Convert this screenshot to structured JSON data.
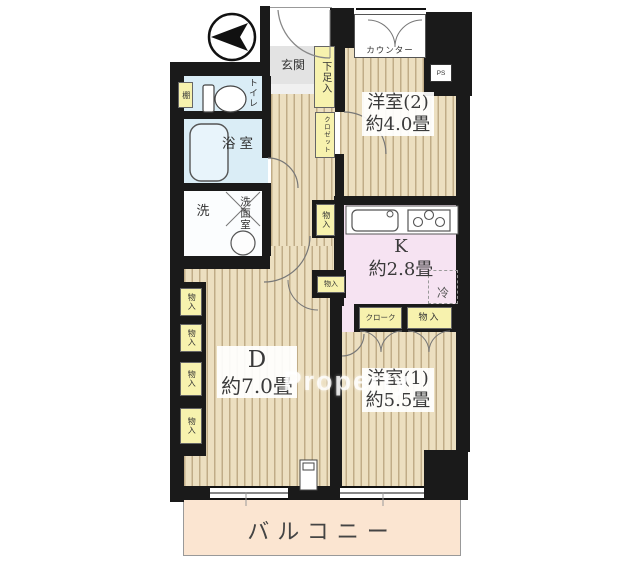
{
  "watermark": "Property",
  "rooms": {
    "western2": {
      "name": "洋室(2)",
      "size": "約4.0畳"
    },
    "western1": {
      "name": "洋室(1)",
      "size": "約5.5畳"
    },
    "dining": {
      "name": "D",
      "size": "約7.0畳"
    },
    "kitchen": {
      "name": "K",
      "size": "約2.8畳"
    },
    "balcony": {
      "name": "バルコニー"
    },
    "entrance": {
      "name": "玄関"
    },
    "bath": {
      "name": "浴室"
    },
    "washroom": {
      "name": "洗面室"
    },
    "laundry": {
      "name": "洗"
    },
    "toilet": {
      "name": "トイレ"
    }
  },
  "fixtures": {
    "counter": "カウンター",
    "shoe_cabinet": "下足入",
    "hall_closet": "クロゼット",
    "shelf": "棚",
    "pipe_space": "PS",
    "refrigerator": "冷",
    "cloak": "クローク"
  },
  "storages": {
    "kitchen_side": "物入",
    "corridor_upper": "物入",
    "corridor_lower": "物入",
    "left_1": "物入",
    "left_2": "物入",
    "left_3": "物入",
    "left_4": "物入"
  },
  "colors": {
    "wall": "#1a1a1a",
    "flooring": "#ecdfc0",
    "kitchen": "#f6e3f2",
    "wet_area": "#daedf6",
    "storage": "#f7f2ae",
    "entrance_floor": "#e3e3e3",
    "balcony": "#fbe5d1"
  }
}
